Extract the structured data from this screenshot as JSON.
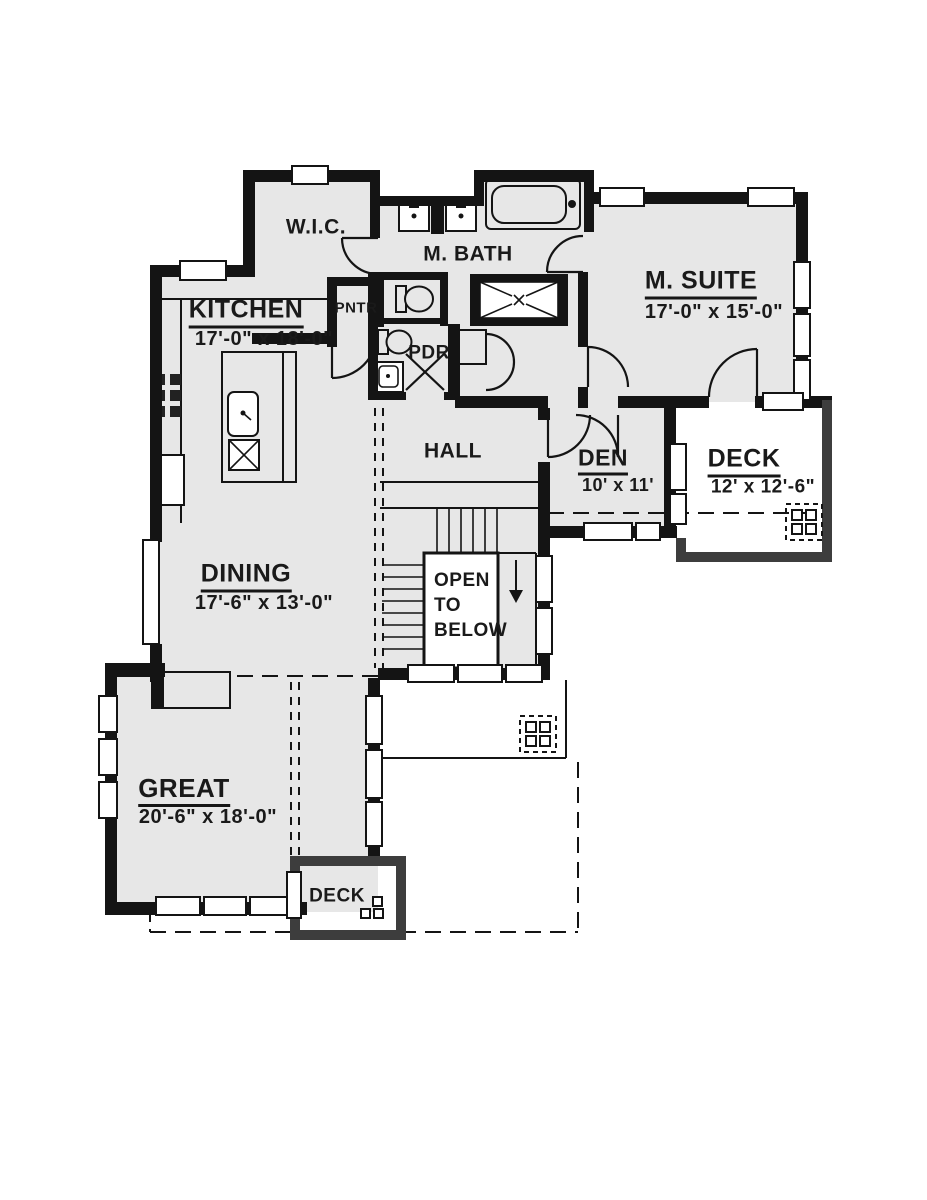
{
  "colors": {
    "background": "#ffffff",
    "wall": "#141414",
    "deck_wall": "#3d3d3d",
    "room_fill": "#e7e7e7",
    "text": "#1a1a1a"
  },
  "rooms": {
    "wic": {
      "name": "W.I.C."
    },
    "mbath": {
      "name": "M. BATH"
    },
    "msuite": {
      "name": "M. SUITE",
      "dims": "17'-0\" x 15'-0\""
    },
    "kitchen": {
      "name": "KITCHEN",
      "dims": "17'-0\" x 18'-0\""
    },
    "pntr": {
      "name": "PNTR"
    },
    "pdr": {
      "name": "PDR"
    },
    "hall": {
      "name": "HALL"
    },
    "den": {
      "name": "DEN",
      "dims": "10' x 11'"
    },
    "deck_right": {
      "name": "DECK",
      "dims": "12' x 12'-6\""
    },
    "open_below": {
      "line1": "OPEN",
      "line2": "TO",
      "line3": "BELOW"
    },
    "dining": {
      "name": "DINING",
      "dims": "17'-6\" x 13'-0\""
    },
    "great": {
      "name": "GREAT",
      "dims": "20'-6\" x 18'-0\""
    },
    "deck_bottom": {
      "name": "DECK"
    }
  }
}
